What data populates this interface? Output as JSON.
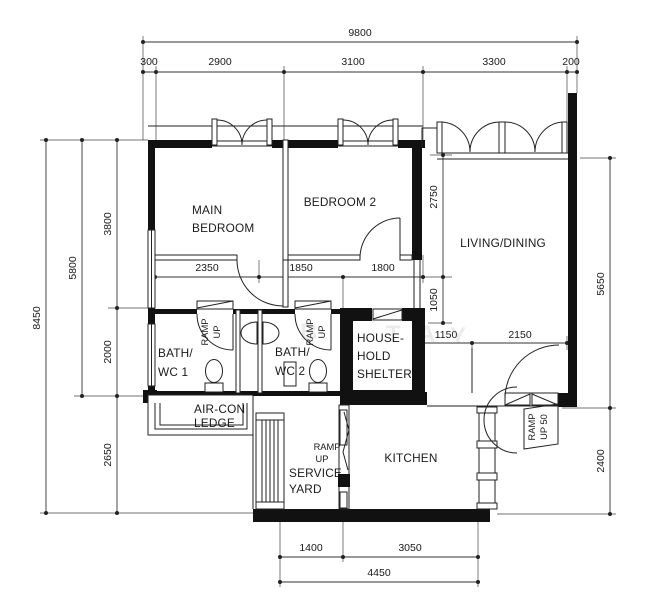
{
  "dims": {
    "total_top": "9800",
    "top": [
      "300",
      "2900",
      "3100",
      "3300",
      "200"
    ],
    "left_total": "8450",
    "left_mid": "5800",
    "left": [
      "3800",
      "2000",
      "2650"
    ],
    "corridor": [
      "2350",
      "1850",
      "1800"
    ],
    "living_v": [
      "2750",
      "1050"
    ],
    "right_upper": "5650",
    "entry": [
      "1150",
      "2150"
    ],
    "right_lower": "2400",
    "bottom": [
      "1400",
      "3050"
    ],
    "bottom_total": "4450"
  },
  "rooms": {
    "main_bedroom": [
      "MAIN",
      "BEDROOM"
    ],
    "bedroom2": "BEDROOM 2",
    "living": "LIVING/DINING",
    "bath1": [
      "BATH/",
      "WC 1"
    ],
    "bath2": [
      "BATH/",
      "WC 2"
    ],
    "household": [
      "HOUSE-",
      "HOLD",
      "SHELTER"
    ],
    "aircon": [
      "AIR-CON",
      "LEDGE"
    ],
    "service": [
      "SERVICE",
      "YARD"
    ],
    "kitchen": "KITCHEN"
  },
  "annotations": {
    "ramp1": [
      "RAMP",
      "UP"
    ],
    "ramp2": [
      "RAMP",
      "UP"
    ],
    "ramp3": [
      "RAMP",
      "UP"
    ],
    "ramp_entry": [
      "RAMP",
      "UP 50"
    ],
    "watermark": [
      "R",
      "B",
      "T",
      "A",
      "Y"
    ]
  },
  "colors": {
    "wall": "#111111",
    "line": "#333333",
    "bg": "#ffffff"
  }
}
